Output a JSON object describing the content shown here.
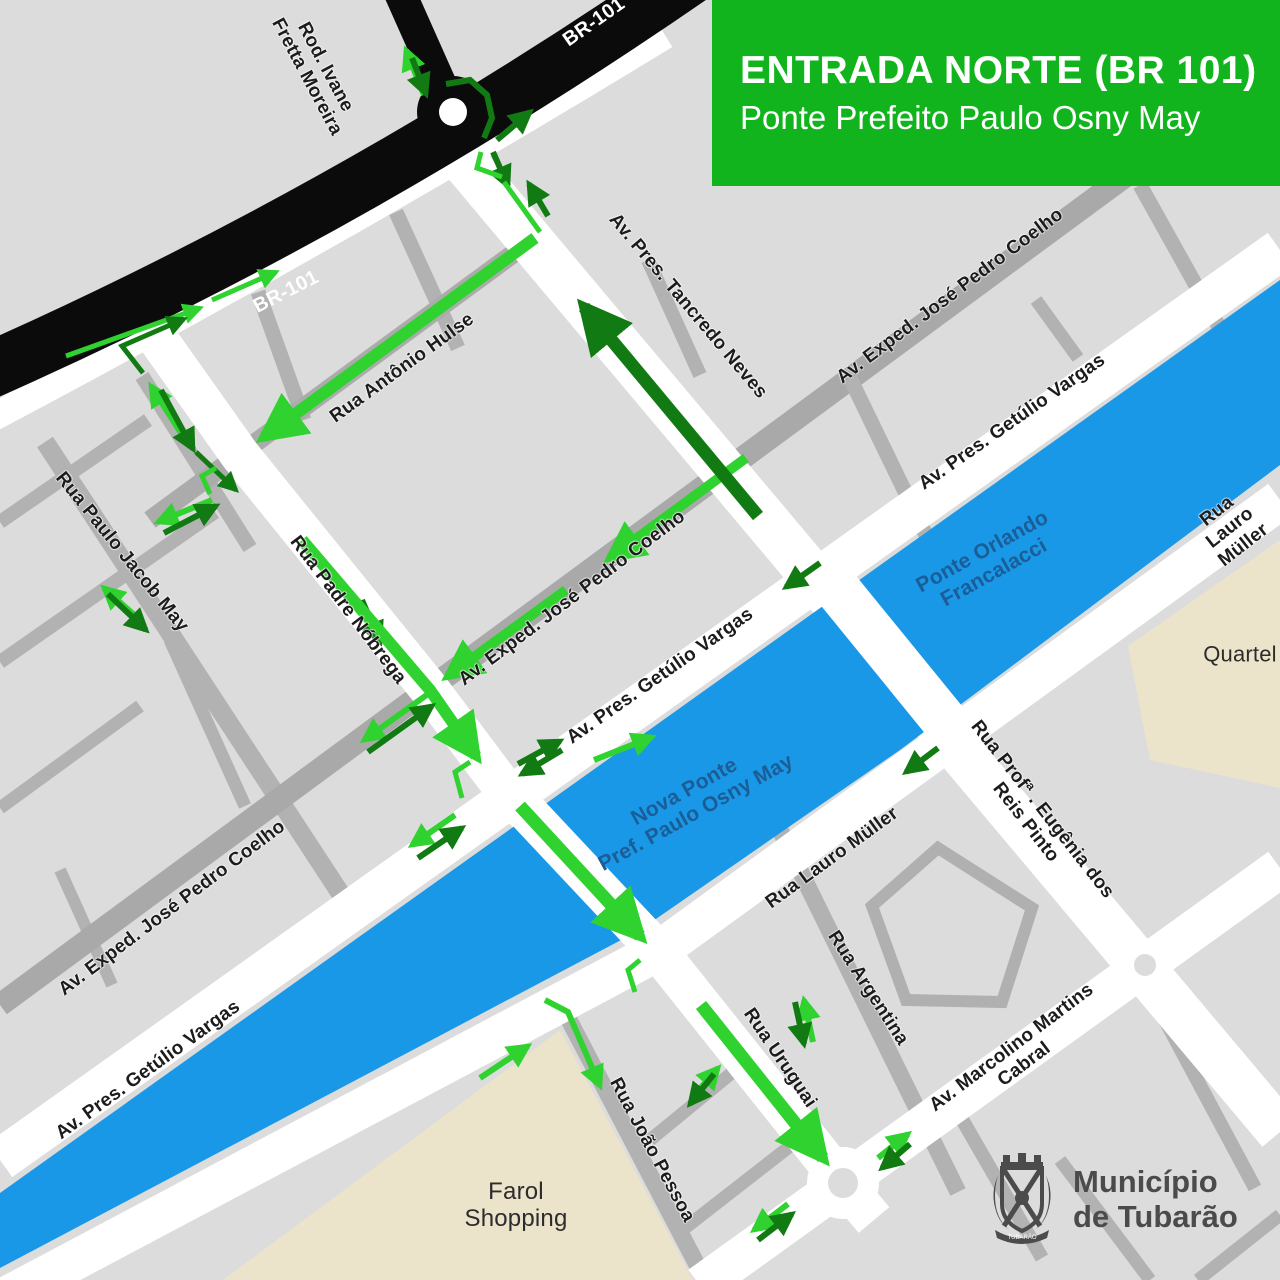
{
  "title": {
    "heading": "ENTRADA NORTE (BR 101)",
    "subheading": "Ponte Prefeito Paulo Osny May"
  },
  "logo": {
    "line1": "Município",
    "line2": "de Tubarão",
    "banner": "TUBARÃO"
  },
  "colors": {
    "background": "#dcdcdc",
    "road_minor": "#b2b2b2",
    "road_mid": "#a9a9a9",
    "road_major": "#ffffff",
    "highway_black": "#0b0b0b",
    "river_blue": "#1a98e8",
    "title_green": "#12b41e",
    "arrow_light_green": "#2fd22f",
    "arrow_dark_green": "#127a12",
    "river_label_blue": "#1b5d97",
    "area_beige": "#ece3cb",
    "logo_gray": "#4b4b4b"
  },
  "map": {
    "labels": [
      {
        "id": "rod-ivane-fretta-moreira",
        "text": "Rod. Ivane\nFretta Moreira",
        "x": 316,
        "y": 72,
        "r": 62,
        "cls": "",
        "size": 19
      },
      {
        "id": "br-101-top",
        "text": "BR-101",
        "x": 594,
        "y": 22,
        "r": -35,
        "cls": "lbl-road-white",
        "size": 20
      },
      {
        "id": "br-101-left",
        "text": "BR-101",
        "x": 286,
        "y": 292,
        "r": -27,
        "cls": "lbl-road-white",
        "size": 20
      },
      {
        "id": "av-pres-tancredo-neves",
        "text": "Av. Pres. Tancredo Neves",
        "x": 688,
        "y": 306,
        "r": 50,
        "cls": "",
        "size": 19
      },
      {
        "id": "rua-antonio-hulse",
        "text": "Rua Antônio Hulse",
        "x": 402,
        "y": 368,
        "r": -36,
        "cls": "",
        "size": 19
      },
      {
        "id": "av-exped-jose-pedro-coelho-ne",
        "text": "Av. Exped. José Pedro Coelho",
        "x": 950,
        "y": 296,
        "r": -37,
        "cls": "",
        "size": 19
      },
      {
        "id": "av-pres-getulio-vargas-ne",
        "text": "Av. Pres. Getúlio Vargas",
        "x": 1012,
        "y": 422,
        "r": -35,
        "cls": "",
        "size": 19
      },
      {
        "id": "rua-lauro-muller-ne",
        "text": "Rua Lauro Müller",
        "x": 1230,
        "y": 528,
        "r": -38,
        "cls": "",
        "size": 19
      },
      {
        "id": "quartel",
        "text": "Quartel",
        "x": 1240,
        "y": 655,
        "r": 0,
        "cls": "lbl-area",
        "size": 22
      },
      {
        "id": "ponte-orlando-francalacci",
        "text": "Ponte Orlando\nFrancalacci",
        "x": 988,
        "y": 562,
        "r": -29,
        "cls": "lbl-river",
        "size": 21
      },
      {
        "id": "av-exped-jose-pedro-coelho-mid",
        "text": "Av. Exped. José Pedro Coelho",
        "x": 572,
        "y": 598,
        "r": -37,
        "cls": "",
        "size": 19
      },
      {
        "id": "rua-padre-nobrega",
        "text": "Rua Padre Nóbrega",
        "x": 348,
        "y": 610,
        "r": 53,
        "cls": "",
        "size": 19
      },
      {
        "id": "rua-paulo-jacob-may",
        "text": "Rua Paulo Jacob May",
        "x": 122,
        "y": 552,
        "r": 51,
        "cls": "",
        "size": 19
      },
      {
        "id": "av-pres-getulio-vargas-mid",
        "text": "Av. Pres. Getúlio Vargas",
        "x": 660,
        "y": 676,
        "r": -35,
        "cls": "",
        "size": 19
      },
      {
        "id": "nova-ponte-pref-paulo-osny-may",
        "text": "Nova Ponte\nPref. Paulo Osny May",
        "x": 690,
        "y": 802,
        "r": -29,
        "cls": "lbl-river",
        "size": 21
      },
      {
        "id": "rua-lauro-muller-mid",
        "text": "Rua Lauro Müller",
        "x": 832,
        "y": 858,
        "r": -36,
        "cls": "",
        "size": 19
      },
      {
        "id": "rua-profa-eugenia-dos-reis-pinto",
        "text": "Rua Profª . Eugênia dos Reis Pinto",
        "x": 1034,
        "y": 816,
        "r": 52,
        "cls": "",
        "size": 19
      },
      {
        "id": "av-exped-jose-pedro-coelho-sw",
        "text": "Av. Exped.  José Pedro Coelho",
        "x": 172,
        "y": 908,
        "r": -37,
        "cls": "",
        "size": 19
      },
      {
        "id": "av-pres-getulio-vargas-sw",
        "text": "Av. Pres. Getúlio Vargas",
        "x": 148,
        "y": 1070,
        "r": -36,
        "cls": "",
        "size": 19
      },
      {
        "id": "farol-shopping",
        "text": "Farol\nShopping",
        "x": 516,
        "y": 1206,
        "r": 0,
        "cls": "lbl-area",
        "size": 24
      },
      {
        "id": "rua-joao-pessoa",
        "text": "Rua João Pessoa",
        "x": 652,
        "y": 1150,
        "r": 62,
        "cls": "",
        "size": 19
      },
      {
        "id": "rua-uruguai",
        "text": "Rua Uruguai",
        "x": 780,
        "y": 1058,
        "r": 56,
        "cls": "",
        "size": 19
      },
      {
        "id": "rua-argentina",
        "text": "Rua Argentina",
        "x": 868,
        "y": 988,
        "r": 57,
        "cls": "",
        "size": 19
      },
      {
        "id": "av-marcolino-martins-cabral",
        "text": "Av. Marcolino Martins Cabral",
        "x": 1018,
        "y": 1056,
        "r": -37,
        "cls": "",
        "size": 19
      }
    ],
    "arrows": [
      {
        "id": "rod-ivane-out",
        "k": "L",
        "w": 6,
        "pts": [
          [
            424,
            95
          ],
          [
            406,
            50
          ]
        ]
      },
      {
        "id": "rod-ivane-in",
        "k": "D",
        "w": 6,
        "pts": [
          [
            412,
            58
          ],
          [
            426,
            94
          ]
        ]
      },
      {
        "id": "roundabout-arc",
        "k": "D",
        "w": 6,
        "head": false,
        "pts": [
          [
            446,
            84
          ],
          [
            470,
            80
          ],
          [
            487,
            95
          ],
          [
            492,
            118
          ],
          [
            484,
            138
          ]
        ]
      },
      {
        "id": "br101-exit-ne",
        "k": "D",
        "w": 6,
        "pts": [
          [
            497,
            140
          ],
          [
            530,
            112
          ]
        ]
      },
      {
        "id": "tancredo-enter",
        "k": "D",
        "w": 6,
        "pts": [
          [
            493,
            152
          ],
          [
            508,
            186
          ]
        ]
      },
      {
        "id": "tancredo-up-small",
        "k": "D",
        "w": 6,
        "pts": [
          [
            548,
            216
          ],
          [
            529,
            184
          ]
        ]
      },
      {
        "id": "turn-bracket-top",
        "k": "L",
        "w": 5,
        "head": false,
        "pts": [
          [
            481,
            152
          ],
          [
            477,
            168
          ],
          [
            502,
            177
          ]
        ]
      },
      {
        "id": "link-to-hulse",
        "k": "L",
        "w": 5,
        "head": false,
        "pts": [
          [
            504,
            182
          ],
          [
            540,
            232
          ]
        ]
      },
      {
        "id": "rua-antonio-hulse-route",
        "k": "L",
        "w": 12,
        "pts": [
          [
            535,
            238
          ],
          [
            264,
            437
          ]
        ]
      },
      {
        "id": "marginal-1",
        "k": "L",
        "w": 5,
        "pts": [
          [
            66,
            356
          ],
          [
            200,
            308
          ]
        ]
      },
      {
        "id": "marginal-2",
        "k": "L",
        "w": 5,
        "pts": [
          [
            212,
            300
          ],
          [
            276,
            272
          ]
        ]
      },
      {
        "id": "marginal-dark-elbow",
        "k": "D",
        "w": 5,
        "pts": [
          [
            143,
            373
          ],
          [
            122,
            346
          ],
          [
            184,
            319
          ]
        ]
      },
      {
        "id": "side-street-up",
        "k": "L",
        "w": 6,
        "pts": [
          [
            190,
            447
          ],
          [
            151,
            386
          ]
        ]
      },
      {
        "id": "side-street-down",
        "k": "D",
        "w": 6,
        "pts": [
          [
            161,
            390
          ],
          [
            193,
            449
          ]
        ]
      },
      {
        "id": "side-street-link",
        "k": "D",
        "w": 5,
        "pts": [
          [
            196,
            452
          ],
          [
            236,
            490
          ]
        ]
      },
      {
        "id": "turn-bracket-west",
        "k": "L",
        "w": 5,
        "head": false,
        "pts": [
          [
            216,
            468
          ],
          [
            202,
            476
          ],
          [
            210,
            494
          ]
        ]
      },
      {
        "id": "cross-street-sw",
        "k": "L",
        "w": 6,
        "pts": [
          [
            212,
            500
          ],
          [
            158,
            522
          ]
        ]
      },
      {
        "id": "cross-street-ne",
        "k": "D",
        "w": 6,
        "pts": [
          [
            164,
            533
          ],
          [
            216,
            506
          ]
        ]
      },
      {
        "id": "jacob-may-up",
        "k": "L",
        "w": 6,
        "pts": [
          [
            142,
            622
          ],
          [
            104,
            588
          ]
        ]
      },
      {
        "id": "jacob-may-down",
        "k": "D",
        "w": 6,
        "pts": [
          [
            108,
            594
          ],
          [
            146,
            630
          ]
        ]
      },
      {
        "id": "nobrega-dark-small",
        "k": "D",
        "w": 6,
        "pts": [
          [
            362,
            600
          ],
          [
            380,
            642
          ]
        ]
      },
      {
        "id": "rua-padre-nobrega-route",
        "k": "L",
        "w": 12,
        "pts": [
          [
            302,
            540
          ],
          [
            430,
            690
          ],
          [
            476,
            756
          ]
        ]
      },
      {
        "id": "jose-pedro-coelho-1",
        "k": "L",
        "w": 10,
        "pts": [
          [
            746,
            458
          ],
          [
            610,
            558
          ]
        ]
      },
      {
        "id": "jose-pedro-coelho-2",
        "k": "L",
        "w": 10,
        "pts": [
          [
            566,
            590
          ],
          [
            448,
            676
          ]
        ]
      },
      {
        "id": "jose-pedro-coelho-pair-l",
        "k": "L",
        "w": 6,
        "pts": [
          [
            428,
            694
          ],
          [
            364,
            740
          ]
        ]
      },
      {
        "id": "jose-pedro-coelho-pair-d",
        "k": "D",
        "w": 6,
        "pts": [
          [
            368,
            752
          ],
          [
            432,
            706
          ]
        ]
      },
      {
        "id": "turn-bracket-crossing",
        "k": "L",
        "w": 5,
        "head": false,
        "pts": [
          [
            470,
            762
          ],
          [
            455,
            772
          ],
          [
            462,
            798
          ]
        ]
      },
      {
        "id": "crossing-west-l",
        "k": "L",
        "w": 6,
        "pts": [
          [
            455,
            815
          ],
          [
            412,
            845
          ]
        ]
      },
      {
        "id": "crossing-west-d",
        "k": "D",
        "w": 6,
        "pts": [
          [
            418,
            858
          ],
          [
            462,
            828
          ]
        ]
      },
      {
        "id": "getulio-pair-ne-1",
        "k": "D",
        "w": 6,
        "pts": [
          [
            518,
            764
          ],
          [
            560,
            741
          ]
        ]
      },
      {
        "id": "getulio-pair-ne-2",
        "k": "D",
        "w": 6,
        "pts": [
          [
            562,
            750
          ],
          [
            522,
            774
          ]
        ]
      },
      {
        "id": "getulio-light-ne",
        "k": "L",
        "w": 6,
        "pts": [
          [
            594,
            760
          ],
          [
            652,
            737
          ]
        ]
      },
      {
        "id": "getulio-dark-sw",
        "k": "D",
        "w": 6,
        "pts": [
          [
            820,
            563
          ],
          [
            786,
            587
          ]
        ]
      },
      {
        "id": "lauro-muller-dark-sw",
        "k": "D",
        "w": 6,
        "pts": [
          [
            938,
            748
          ],
          [
            906,
            772
          ]
        ]
      },
      {
        "id": "nova-ponte-route",
        "k": "L",
        "w": 13,
        "pts": [
          [
            520,
            806
          ],
          [
            640,
            936
          ]
        ]
      },
      {
        "id": "turn-bracket-landing",
        "k": "L",
        "w": 5,
        "head": false,
        "pts": [
          [
            640,
            960
          ],
          [
            628,
            970
          ],
          [
            635,
            992
          ]
        ]
      },
      {
        "id": "rua-uruguai-route",
        "k": "L",
        "w": 13,
        "pts": [
          [
            701,
            1005
          ],
          [
            823,
            1158
          ]
        ]
      },
      {
        "id": "marcolino-ne-l",
        "k": "L",
        "w": 6,
        "pts": [
          [
            878,
            1158
          ],
          [
            908,
            1134
          ]
        ]
      },
      {
        "id": "marcolino-ne-d",
        "k": "D",
        "w": 6,
        "pts": [
          [
            910,
            1144
          ],
          [
            882,
            1168
          ]
        ]
      },
      {
        "id": "marcolino-sw-l",
        "k": "L",
        "w": 6,
        "pts": [
          [
            788,
            1204
          ],
          [
            754,
            1230
          ]
        ]
      },
      {
        "id": "marcolino-sw-d",
        "k": "D",
        "w": 6,
        "pts": [
          [
            758,
            1240
          ],
          [
            792,
            1214
          ]
        ]
      },
      {
        "id": "joao-pessoa-stub-l",
        "k": "L",
        "w": 6,
        "pts": [
          [
            692,
            1098
          ],
          [
            718,
            1068
          ]
        ]
      },
      {
        "id": "joao-pessoa-stub-d",
        "k": "D",
        "w": 6,
        "pts": [
          [
            714,
            1074
          ],
          [
            690,
            1104
          ]
        ]
      },
      {
        "id": "argentina-up",
        "k": "L",
        "w": 6,
        "pts": [
          [
            813,
            1042
          ],
          [
            804,
            1000
          ]
        ]
      },
      {
        "id": "argentina-down",
        "k": "D",
        "w": 6,
        "pts": [
          [
            795,
            1002
          ],
          [
            804,
            1044
          ]
        ]
      },
      {
        "id": "farol-ne",
        "k": "L",
        "w": 6,
        "pts": [
          [
            480,
            1078
          ],
          [
            528,
            1046
          ]
        ]
      },
      {
        "id": "farol-elbow",
        "k": "L",
        "w": 6,
        "pts": [
          [
            545,
            1000
          ],
          [
            568,
            1012
          ],
          [
            600,
            1086
          ]
        ]
      },
      {
        "id": "tancredo-neves-route",
        "k": "D",
        "w": 13,
        "pts": [
          [
            758,
            516
          ],
          [
            584,
            307
          ]
        ]
      }
    ]
  }
}
